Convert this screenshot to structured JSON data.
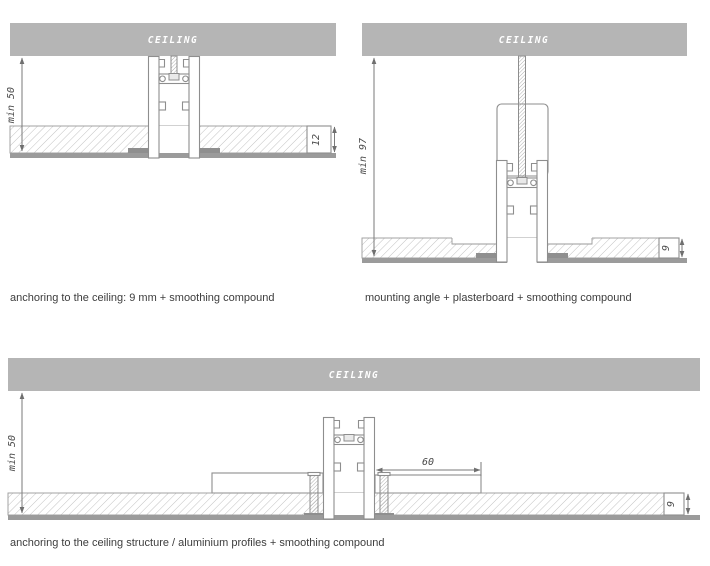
{
  "colors": {
    "ceiling_fill": "#b5b5b5",
    "ceiling_text": "#ffffff",
    "drawing_line": "#8e8e8e",
    "surface_line": "#9b9b9b",
    "hatch_line": "#c2c2c2",
    "dim_text": "#4a4a4a",
    "caption_text": "#3d3d3d"
  },
  "diagrams": {
    "top_left": {
      "ceiling_label": "CEILING",
      "height_dim": "min 50",
      "board_dim": "12",
      "caption": "anchoring to the ceiling: 9 mm + smoothing compound"
    },
    "top_right": {
      "ceiling_label": "CEILING",
      "height_dim": "min 97",
      "board_dim": "9",
      "caption": "mounting angle + plasterboard + smoothing compound"
    },
    "bottom": {
      "ceiling_label": "CEILING",
      "height_dim": "min 50",
      "width_dim": "60",
      "board_dim": "9",
      "caption": "anchoring to the ceiling structure / aluminium profiles + smoothing compound"
    }
  }
}
